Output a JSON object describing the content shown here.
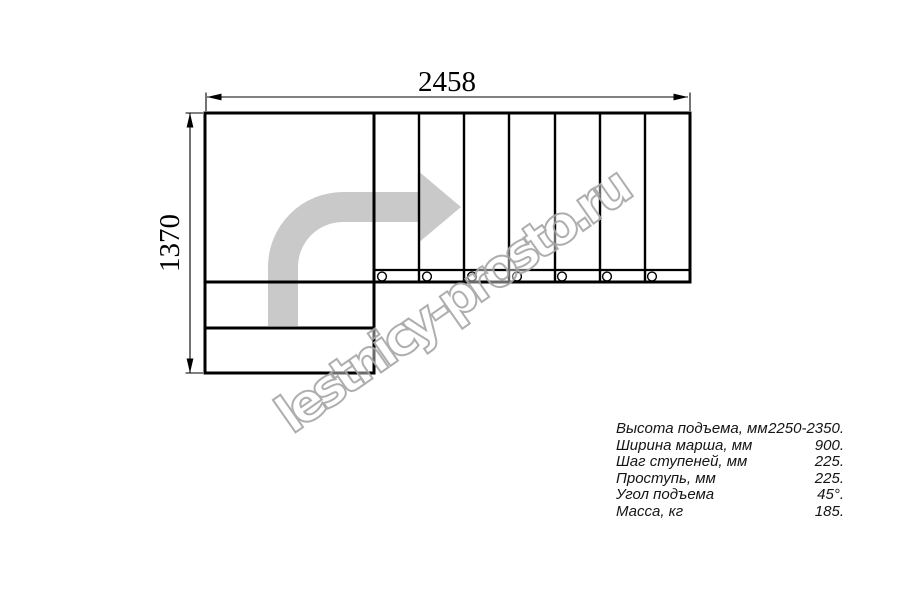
{
  "drawing": {
    "watermark": "lestnicy-prosto.ru",
    "width_dimension_label": "2458",
    "height_dimension_label": "1370"
  },
  "colors": {
    "line": "#000000",
    "arrow": "#c9c9c9",
    "watermark": "#a8a8a8",
    "baluster_fill": "#ffffff"
  },
  "specs": {
    "rows": [
      {
        "label": "Высота подъема, мм",
        "value": "2250-2350."
      },
      {
        "label": "Ширина марша, мм",
        "value": "900."
      },
      {
        "label": "Шаг ступеней, мм",
        "value": "225."
      },
      {
        "label": "Проступь, мм",
        "value": "225."
      },
      {
        "label": "Угол подъема",
        "value": "45°."
      },
      {
        "label": "Масса, кг",
        "value": "185."
      }
    ]
  }
}
